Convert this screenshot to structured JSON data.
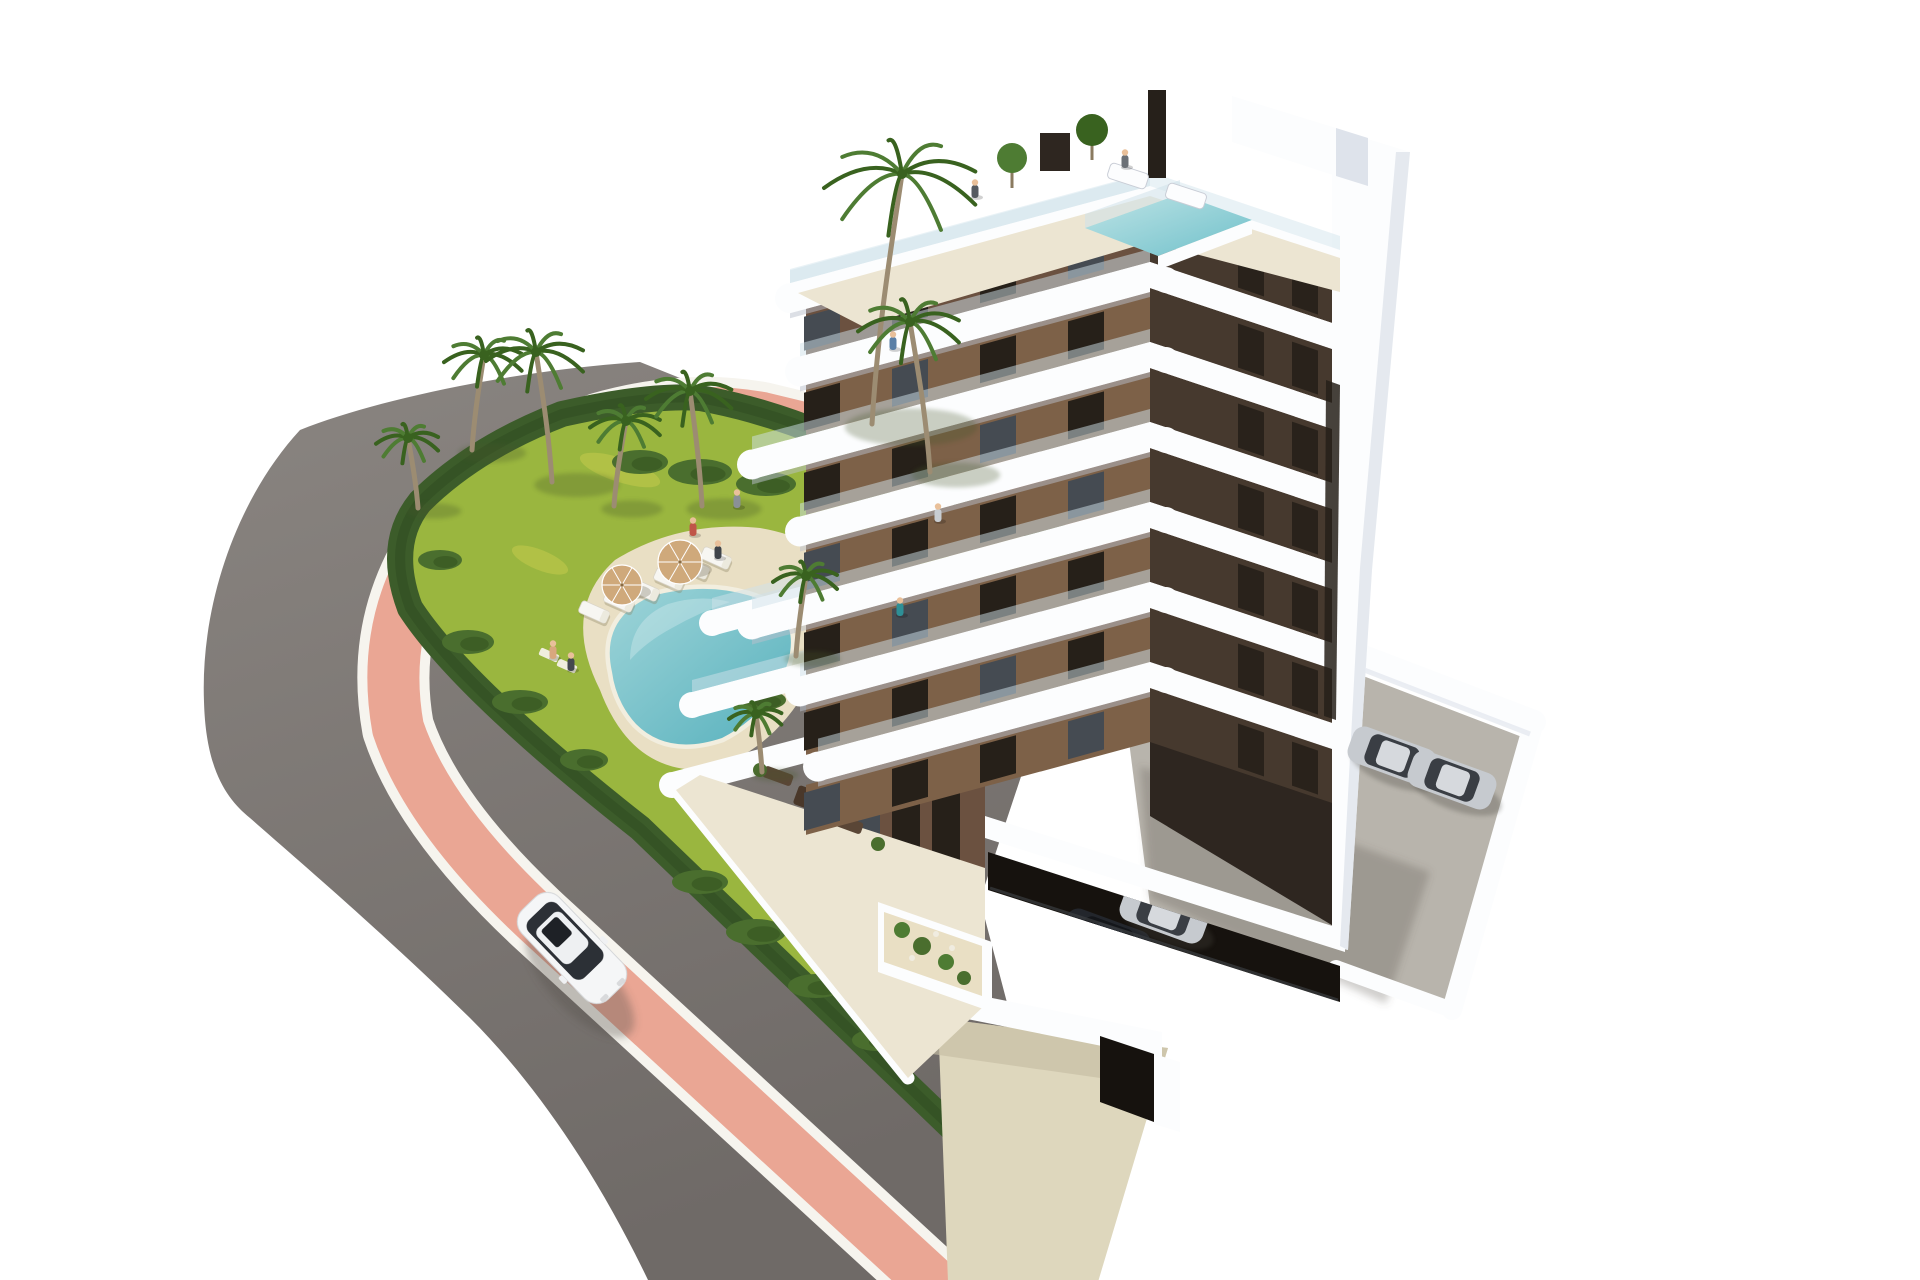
{
  "meta": {
    "type": "architectural-3d-render",
    "view": "aerial-corner",
    "subject": "8-storey white and brown apartment building with rooftop pool, communal garden pool, palm trees, corner plot with curved road and pink cycle lane",
    "width": 1920,
    "height": 1280
  },
  "palette": {
    "sky": "#ffffff",
    "road": "#837e7a",
    "roadDark": "#6f6a67",
    "curb": "#f6f4ee",
    "pinkLane": "#eaa694",
    "grass": "#9ab63f",
    "grassLight": "#c8cc4e",
    "hedge": "#3c5c2a",
    "hedgeDark": "#2e4a1f",
    "sand": "#e9dfc4",
    "sandShadow": "#d6cbae",
    "poolRim": "#f2eedf",
    "poolWater1": "#9ed4d8",
    "poolWater2": "#57b1bd",
    "palmTrunk": "#9c8c72",
    "palmGreen": "#4e7c33",
    "palmGreenDark": "#39621f",
    "bush": "#4a6e2e",
    "bushDark": "#35531f",
    "white": "#fcfdfe",
    "slabShade": "#b9c0cc",
    "slabShade2": "#dee3eb",
    "glass": "#cfe2ea",
    "brownLight": "#7d6148",
    "brownMid": "#6b5140",
    "brownDark": "#46392e",
    "brownDeep": "#2e2620",
    "window": "#262019",
    "windowGlass": "#454b52",
    "roofFloor": "#ece5d2",
    "concrete": "#b8b4ac",
    "paveBeige": "#ded7bd",
    "paveShadow": "#c4bda3",
    "garage": "#16120e",
    "carWhite": "#f5f6f7",
    "carSilver": "#c6cacf",
    "carDark": "#23262c",
    "shadowSoft": "#55504a",
    "skin": "#e9c09a"
  },
  "scene": {
    "building": {
      "storeys": 8,
      "corner_x": 1150,
      "left_slope": 0.27,
      "right_slope": 0.335,
      "band_h": 30,
      "right_band_h": 26,
      "left_wall_end": 806,
      "right_end": 1340,
      "base_y": 742,
      "floor_tops": [
        186,
        262,
        342,
        422,
        502,
        582,
        662
      ],
      "left_ends": [
        790,
        800,
        752,
        800,
        752,
        800,
        818
      ],
      "right_windows_x": [
        1238,
        1292
      ],
      "roof_pool": "1085,228 1180,194 1252,220 1158,256"
    },
    "palms": [
      [
        418,
        508,
        70,
        -10,
        32
      ],
      [
        472,
        450,
        95,
        12,
        40
      ],
      [
        552,
        482,
        130,
        -16,
        50
      ],
      [
        614,
        506,
        85,
        12,
        36
      ],
      [
        702,
        506,
        115,
        -12,
        44
      ],
      [
        872,
        424,
        250,
        30,
        78
      ],
      [
        930,
        472,
        150,
        -20,
        52
      ],
      [
        796,
        656,
        80,
        10,
        33
      ],
      [
        762,
        772,
        58,
        -6,
        27
      ]
    ],
    "bushes": [
      [
        640,
        462,
        28,
        12
      ],
      [
        700,
        472,
        32,
        13
      ],
      [
        766,
        484,
        30,
        12
      ],
      [
        822,
        452,
        26,
        11
      ],
      [
        872,
        500,
        26,
        11
      ],
      [
        440,
        560,
        22,
        10
      ],
      [
        468,
        642,
        26,
        12
      ],
      [
        520,
        702,
        28,
        12
      ],
      [
        584,
        760,
        24,
        11
      ],
      [
        700,
        882,
        28,
        12
      ],
      [
        756,
        932,
        30,
        13
      ],
      [
        816,
        986,
        28,
        12
      ],
      [
        876,
        1040,
        24,
        11
      ],
      [
        762,
        700,
        24,
        10
      ],
      [
        930,
        530,
        24,
        10
      ],
      [
        1010,
        556,
        26,
        11
      ]
    ],
    "loungers": [
      [
        594,
        612
      ],
      [
        619,
        601
      ],
      [
        644,
        590
      ],
      [
        669,
        579
      ],
      [
        694,
        568
      ],
      [
        716,
        558
      ]
    ],
    "mats": [
      [
        549,
        655
      ],
      [
        567,
        666
      ]
    ],
    "umbrellas": [
      [
        622,
        585,
        20
      ],
      [
        680,
        562,
        22
      ]
    ],
    "people": [
      [
        975,
        196,
        "#555a60"
      ],
      [
        893,
        348,
        "#5a7fa6"
      ],
      [
        900,
        614,
        "#2e8f96"
      ],
      [
        693,
        534,
        "#c05548"
      ],
      [
        718,
        557,
        "#3f444a"
      ],
      [
        553,
        657,
        "#d9a77e"
      ],
      [
        571,
        669,
        "#44484e"
      ],
      [
        737,
        506,
        "#8a9096"
      ],
      [
        1125,
        166,
        "#6b7076"
      ],
      [
        938,
        520,
        "#c8cdd2"
      ]
    ],
    "parked_cars": [
      [
        1392,
        756,
        20,
        "silver"
      ],
      [
        1452,
        780,
        20,
        "silver"
      ]
    ],
    "garage_cars": [
      [
        996,
        982,
        20,
        "dark"
      ],
      [
        1048,
        960,
        20,
        "dark"
      ],
      [
        1106,
        938,
        20,
        "dark"
      ],
      [
        1164,
        914,
        20,
        "silver"
      ],
      [
        1222,
        890,
        20,
        "silver"
      ]
    ],
    "white_car": {
      "x": 572,
      "y": 948,
      "rot": 46
    }
  }
}
